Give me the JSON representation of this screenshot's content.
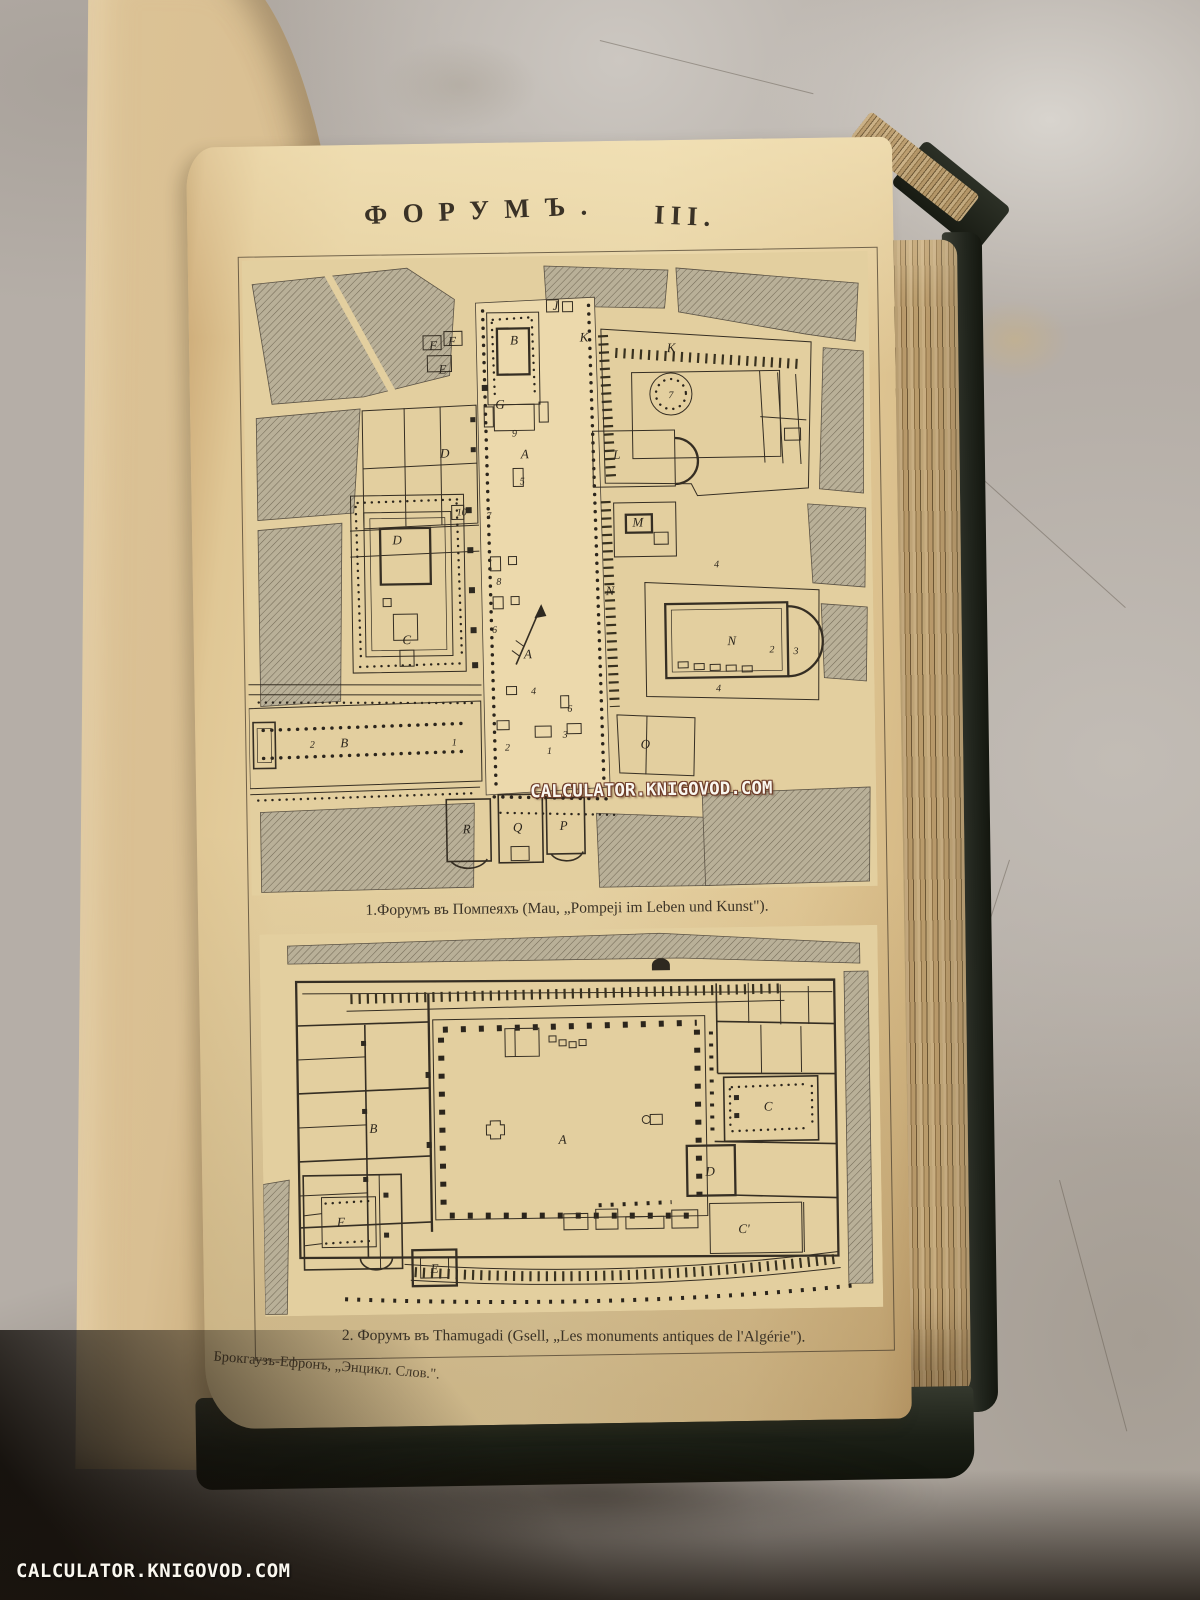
{
  "photo": {
    "watermark_center": "CALCULATOR.KNIGOVOD.COM",
    "watermark_corner": "CALCULATOR.KNIGOVOD.COM"
  },
  "page": {
    "title_word": "ФОРУМЪ.",
    "title_numeral": "III.",
    "caption_plan1": "1.Форумъ въ Помпеяхъ (Mau, „Pompeji im Leben und Kunst\").",
    "caption_plan2": "2. Форумъ въ Thamugadi (Gsell, „Les monuments antiques de l'Algérie\").",
    "publisher_line": "Брокгаузъ-Ефронъ, „Энцикл. Слов.\"."
  },
  "plan1": {
    "name": "Форумъ въ Помпеяхъ",
    "labels": [
      {
        "t": "F",
        "x": 190,
        "y": 92
      },
      {
        "t": "F",
        "x": 209,
        "y": 88
      },
      {
        "t": "E",
        "x": 199,
        "y": 116
      },
      {
        "t": "D",
        "x": 200,
        "y": 200
      },
      {
        "t": "D",
        "x": 151,
        "y": 286
      },
      {
        "t": "B",
        "x": 271,
        "y": 88
      },
      {
        "t": "G",
        "x": 256,
        "y": 152
      },
      {
        "t": "J",
        "x": 313,
        "y": 54
      },
      {
        "t": "K",
        "x": 341,
        "y": 86
      },
      {
        "t": "K",
        "x": 428,
        "y": 98
      },
      {
        "t": "L",
        "x": 372,
        "y": 204
      },
      {
        "t": "M",
        "x": 392,
        "y": 272
      },
      {
        "t": "A",
        "x": 280,
        "y": 202
      },
      {
        "t": "A",
        "x": 280,
        "y": 402
      },
      {
        "t": "N",
        "x": 363,
        "y": 340
      },
      {
        "t": "N",
        "x": 484,
        "y": 392
      },
      {
        "t": "O",
        "x": 396,
        "y": 494
      },
      {
        "t": "C",
        "x": 159,
        "y": 386
      },
      {
        "t": "B",
        "x": 95,
        "y": 488
      },
      {
        "t": "R",
        "x": 216,
        "y": 576
      },
      {
        "t": "Q",
        "x": 267,
        "y": 575
      },
      {
        "t": "P",
        "x": 313,
        "y": 574
      }
    ],
    "numbers": [
      {
        "t": "9",
        "x": 270,
        "y": 180
      },
      {
        "t": "5",
        "x": 277,
        "y": 228
      },
      {
        "t": "7",
        "x": 243,
        "y": 262
      },
      {
        "t": "10",
        "x": 216,
        "y": 258
      },
      {
        "t": "8",
        "x": 252,
        "y": 328
      },
      {
        "t": "6",
        "x": 247,
        "y": 376
      },
      {
        "t": "7",
        "x": 427,
        "y": 144
      },
      {
        "t": "4",
        "x": 470,
        "y": 314
      },
      {
        "t": "4",
        "x": 470,
        "y": 438
      },
      {
        "t": "2",
        "x": 524,
        "y": 400
      },
      {
        "t": "3",
        "x": 548,
        "y": 402
      },
      {
        "t": "2",
        "x": 63,
        "y": 488
      },
      {
        "t": "1",
        "x": 205,
        "y": 488
      },
      {
        "t": "2",
        "x": 258,
        "y": 494
      },
      {
        "t": "1",
        "x": 300,
        "y": 498
      },
      {
        "t": "3",
        "x": 316,
        "y": 482
      },
      {
        "t": "4",
        "x": 285,
        "y": 438
      },
      {
        "t": "6",
        "x": 321,
        "y": 456
      }
    ]
  },
  "plan2": {
    "name": "Форумъ въ Thamugadi",
    "labels": [
      {
        "t": "B",
        "x": 111,
        "y": 200
      },
      {
        "t": "A",
        "x": 300,
        "y": 214
      },
      {
        "t": "C",
        "x": 506,
        "y": 184
      },
      {
        "t": "D",
        "x": 447,
        "y": 248
      },
      {
        "t": "C'",
        "x": 480,
        "y": 306
      },
      {
        "t": "E",
        "x": 170,
        "y": 341
      },
      {
        "t": "F",
        "x": 77,
        "y": 293
      }
    ]
  },
  "colors": {
    "paper": "#e3cf9f",
    "ink": "#352e23",
    "cover": "#21251d",
    "marble": "#b5aea7",
    "hatch_block": "#b9b098"
  }
}
